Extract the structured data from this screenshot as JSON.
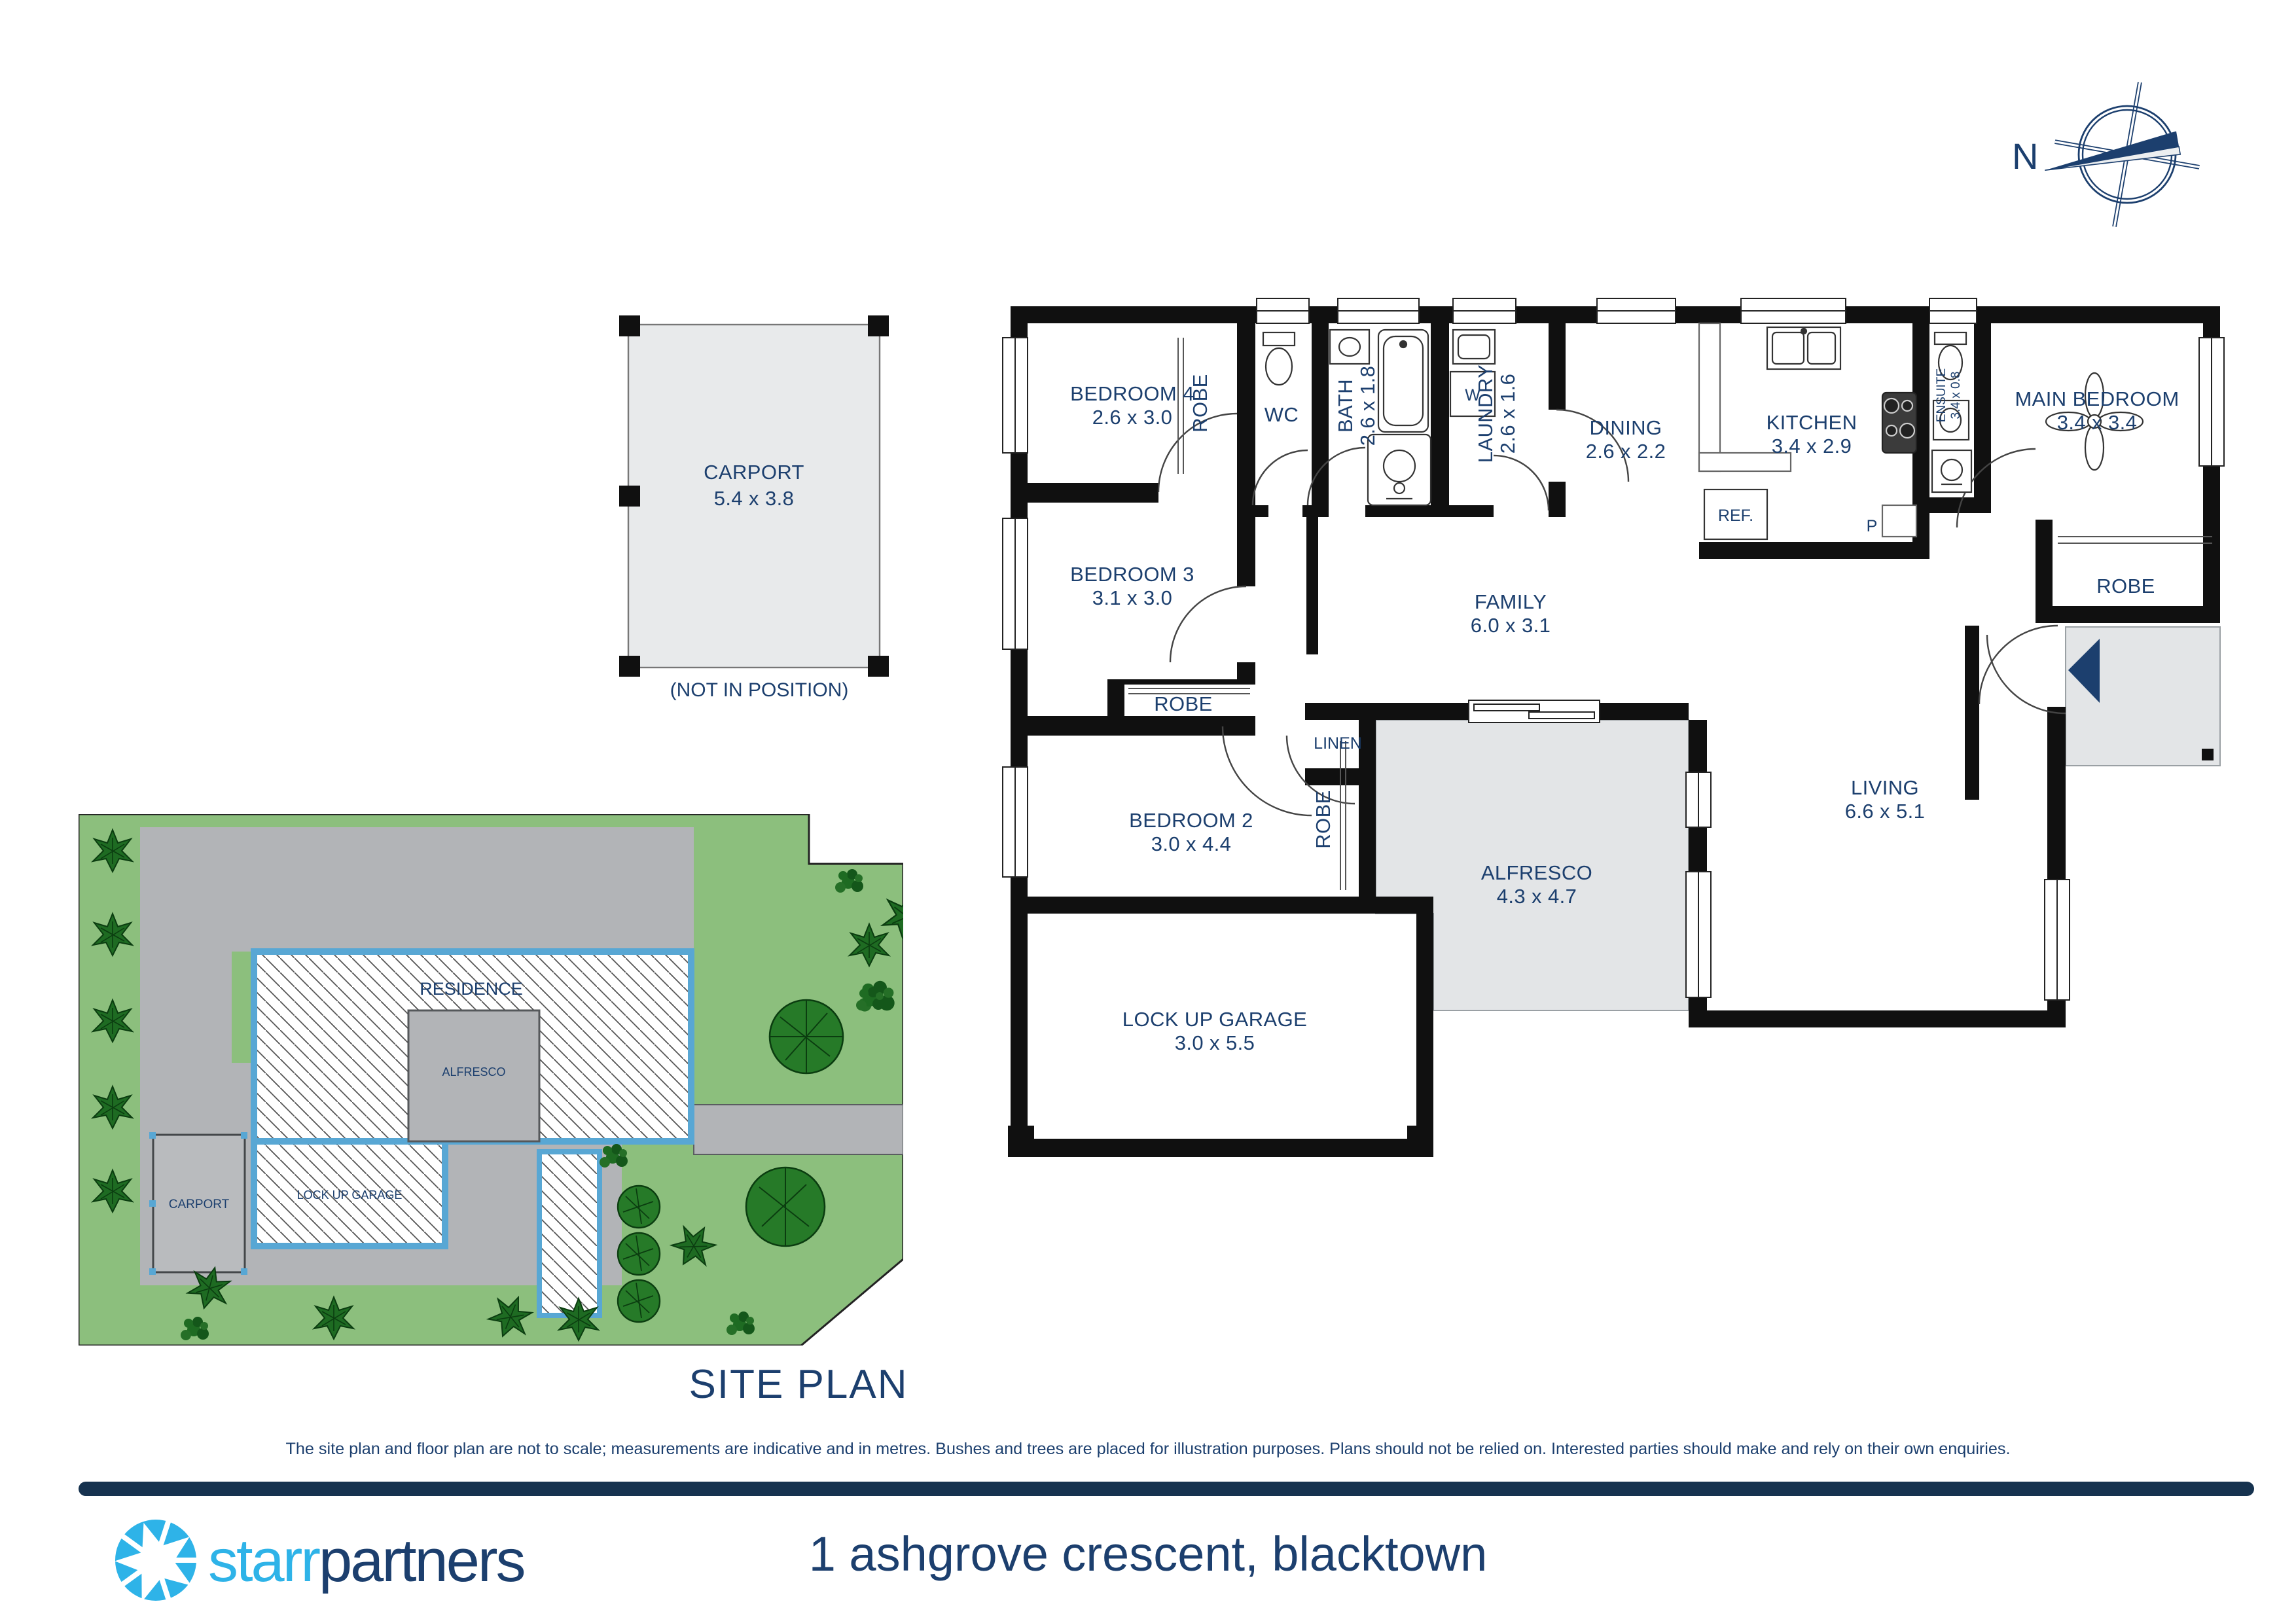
{
  "colors": {
    "text_navy": "#1c3f6e",
    "wall_black": "#101010",
    "plan_gray": "#e3e5e7",
    "site_green": "#8cbf7d",
    "site_drive_gray": "#b2b4b7",
    "site_residence_border_blue": "#58a7d4",
    "tree_dark_green": "#1e6b22",
    "logo_light_blue": "#2eb3e8",
    "divider_navy": "#16324f"
  },
  "compass": {
    "north_label": "N"
  },
  "carport_diagram": {
    "label": "CARPORT",
    "dims": "5.4 x 3.8",
    "note": "(NOT IN POSITION)"
  },
  "floor_plan": {
    "rooms": {
      "bedroom4": {
        "label": "BEDROOM 4",
        "dims": "2.6 x 3.0"
      },
      "robe4": {
        "label": "ROBE"
      },
      "wc": {
        "label": "WC"
      },
      "bath": {
        "label": "BATH",
        "dims": "2.6 x 1.8"
      },
      "laundry": {
        "label": "LAUNDRY",
        "dims": "2.6 x 1.6"
      },
      "washer": {
        "label": "W"
      },
      "dining": {
        "label": "DINING",
        "dims": "2.6 x 2.2"
      },
      "kitchen": {
        "label": "KITCHEN",
        "dims": "3.4 x 2.9"
      },
      "fridge": {
        "label": "REF."
      },
      "pantry": {
        "label": "P"
      },
      "ensuite": {
        "label": "ENSUITE",
        "dims": "3.4 x 0.8"
      },
      "main_bedroom": {
        "label": "MAIN BEDROOM",
        "dims": "3.4 x 3.4"
      },
      "robe_main": {
        "label": "ROBE"
      },
      "bedroom3": {
        "label": "BEDROOM 3",
        "dims": "3.1 x 3.0"
      },
      "robe3": {
        "label": "ROBE"
      },
      "family": {
        "label": "FAMILY",
        "dims": "6.0 x 3.1"
      },
      "linen": {
        "label": "LINEN"
      },
      "bedroom2": {
        "label": "BEDROOM 2",
        "dims": "3.0 x 4.4"
      },
      "robe2": {
        "label": "ROBE"
      },
      "alfresco": {
        "label": "ALFRESCO",
        "dims": "4.3 x 4.7"
      },
      "living": {
        "label": "LIVING",
        "dims": "6.6 x 5.1"
      },
      "garage": {
        "label": "LOCK UP GARAGE",
        "dims": "3.0 x 5.5"
      }
    }
  },
  "site_plan": {
    "title": "SITE PLAN",
    "labels": {
      "residence": "RESIDENCE",
      "alfresco": "ALFRESCO",
      "garage": "LOCK UP GARAGE",
      "carport": "CARPORT"
    }
  },
  "disclaimer": {
    "text": "The site plan and floor plan are not to scale; measurements are indicative and in metres. Bushes and trees are placed for illustration purposes. Plans should not be relied on. Interested parties should make and rely on their own enquiries."
  },
  "footer": {
    "brand_light": "starr",
    "brand_dark": "partners",
    "address": "1 ashgrove crescent, blacktown"
  }
}
